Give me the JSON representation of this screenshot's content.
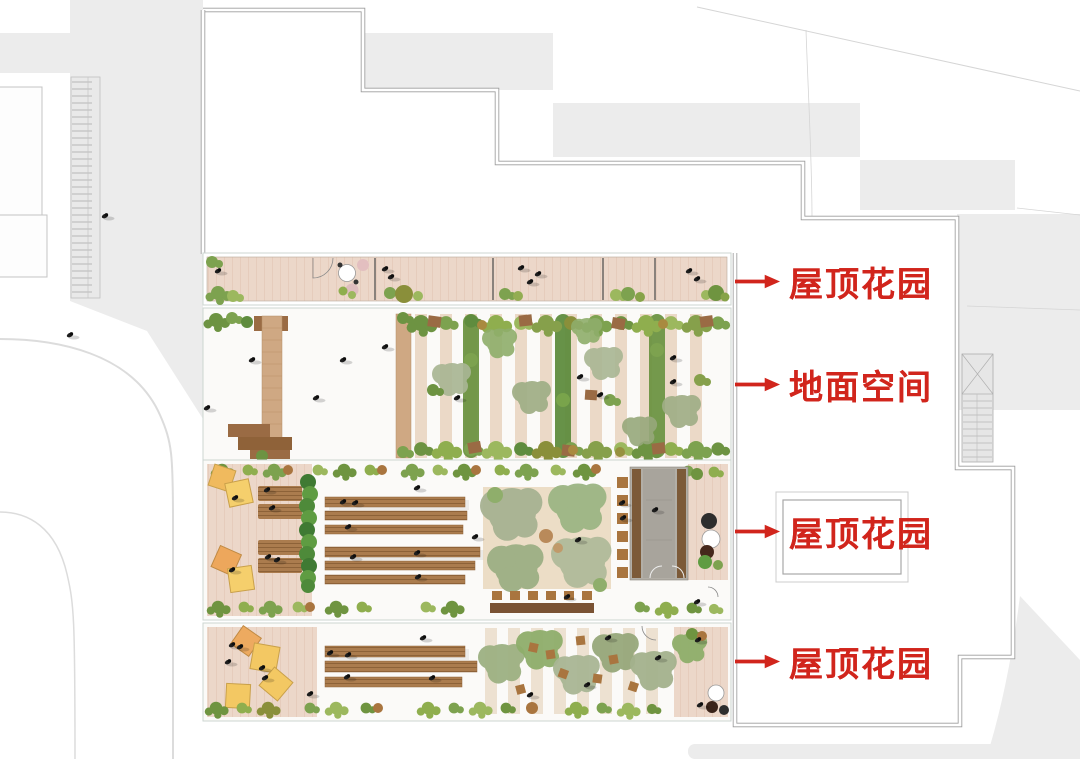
{
  "annotations": [
    {
      "id": "roof-garden-top",
      "text": "屋顶花园"
    },
    {
      "id": "ground-space",
      "text": "地面空间"
    },
    {
      "id": "roof-garden-middle",
      "text": "屋顶花园"
    },
    {
      "id": "roof-garden-bottom",
      "text": "屋顶花园"
    }
  ],
  "icons": {
    "arrow_right": "→"
  },
  "colors": {
    "annotation_red": "#d1251c",
    "deck_wood": "#ecd7c9",
    "boardwalk_wood": "#cfa883",
    "bench_wood": "#ab7c4e",
    "dark_wood": "#7c5a38",
    "foliage_green": "#7da24f",
    "sage_tree": "#a9b694",
    "cushion_yellow": "#f3c863",
    "cushion_orange": "#edaa60",
    "surround_gray": "#ececec",
    "boundary_line": "#9c9c9c",
    "pavilion_gray": "#b2aea6",
    "plaza_tan": "#ead9c0"
  }
}
